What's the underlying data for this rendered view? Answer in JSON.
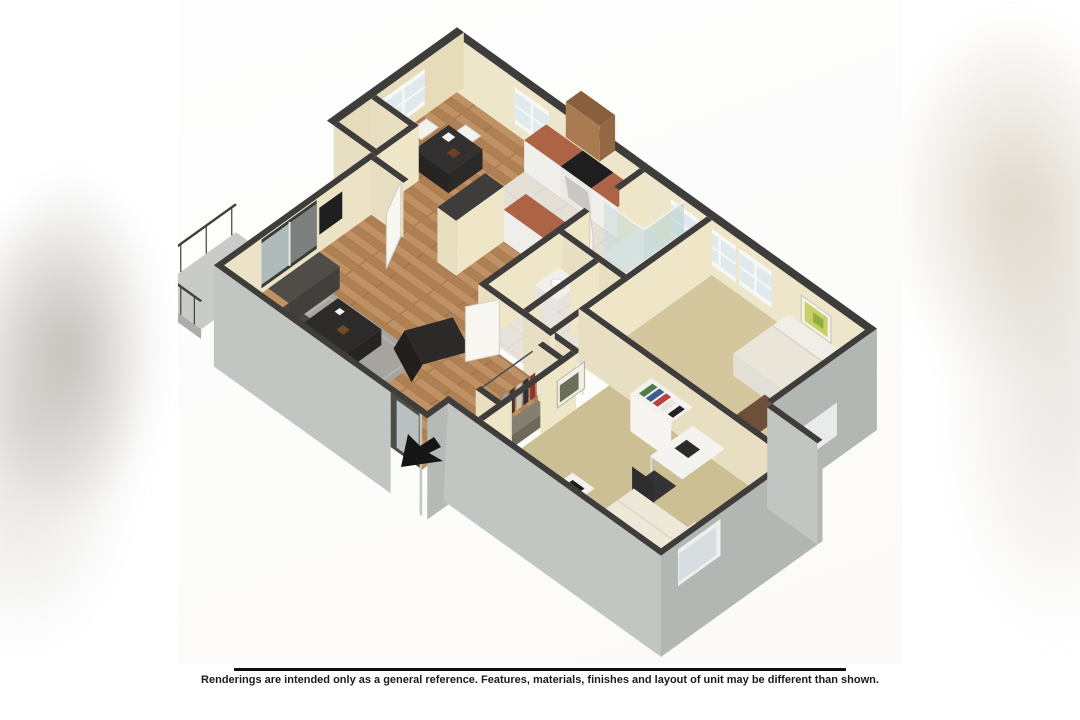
{
  "footer": {
    "disclaimer": "Renderings are intended only as a general reference. Features, materials, finishes and layout of unit may be different than shown."
  },
  "floor_plan": {
    "type": "3d-isometric-floor-plan-rendering",
    "entry_arrow_icon": "black-entry-arrow",
    "palette": {
      "wall_cap": "#3e3d3b",
      "interior_wall_face": "#ece3c6",
      "exterior_wall_face": "#c2c6c3",
      "wood_floor": "#b5895c",
      "carpet_master": "#d4c79d",
      "carpet_bedroom2": "#cdbf94",
      "tile": "#e4e0d6",
      "countertop": "#ad6346",
      "cabinet_wood": "#aa7a50",
      "window_glass": "#dfe9ee",
      "background": "#ffffff"
    }
  }
}
